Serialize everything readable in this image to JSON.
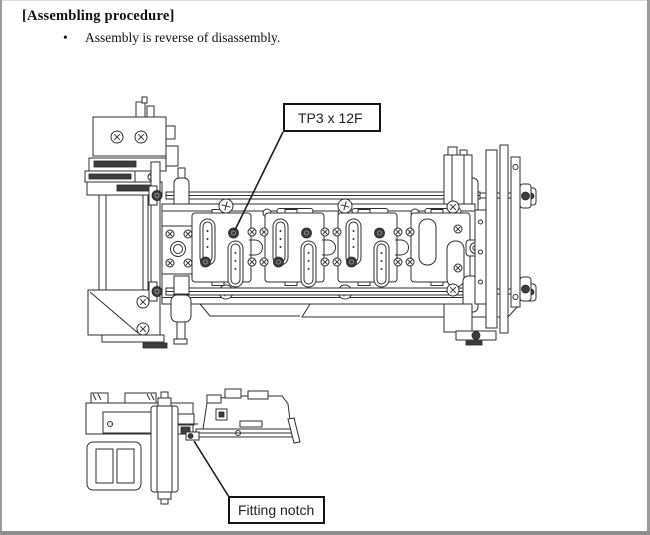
{
  "document": {
    "heading": "[Assembling procedure]",
    "bullet": {
      "marker": "•",
      "text": "Assembly is reverse of disassembly."
    }
  },
  "callouts": {
    "screw": {
      "label": "TP3 x 12F"
    },
    "notch": {
      "label": "Fitting notch"
    }
  },
  "figures": {
    "front_view": "mechanism-front-view-diagram",
    "side_view": "mechanism-side-view-diagram"
  },
  "colors": {
    "line": "#2f2f2f",
    "dark_fill": "#3d3d3d",
    "page_border": "#9b9b9b",
    "background": "#ffffff"
  }
}
